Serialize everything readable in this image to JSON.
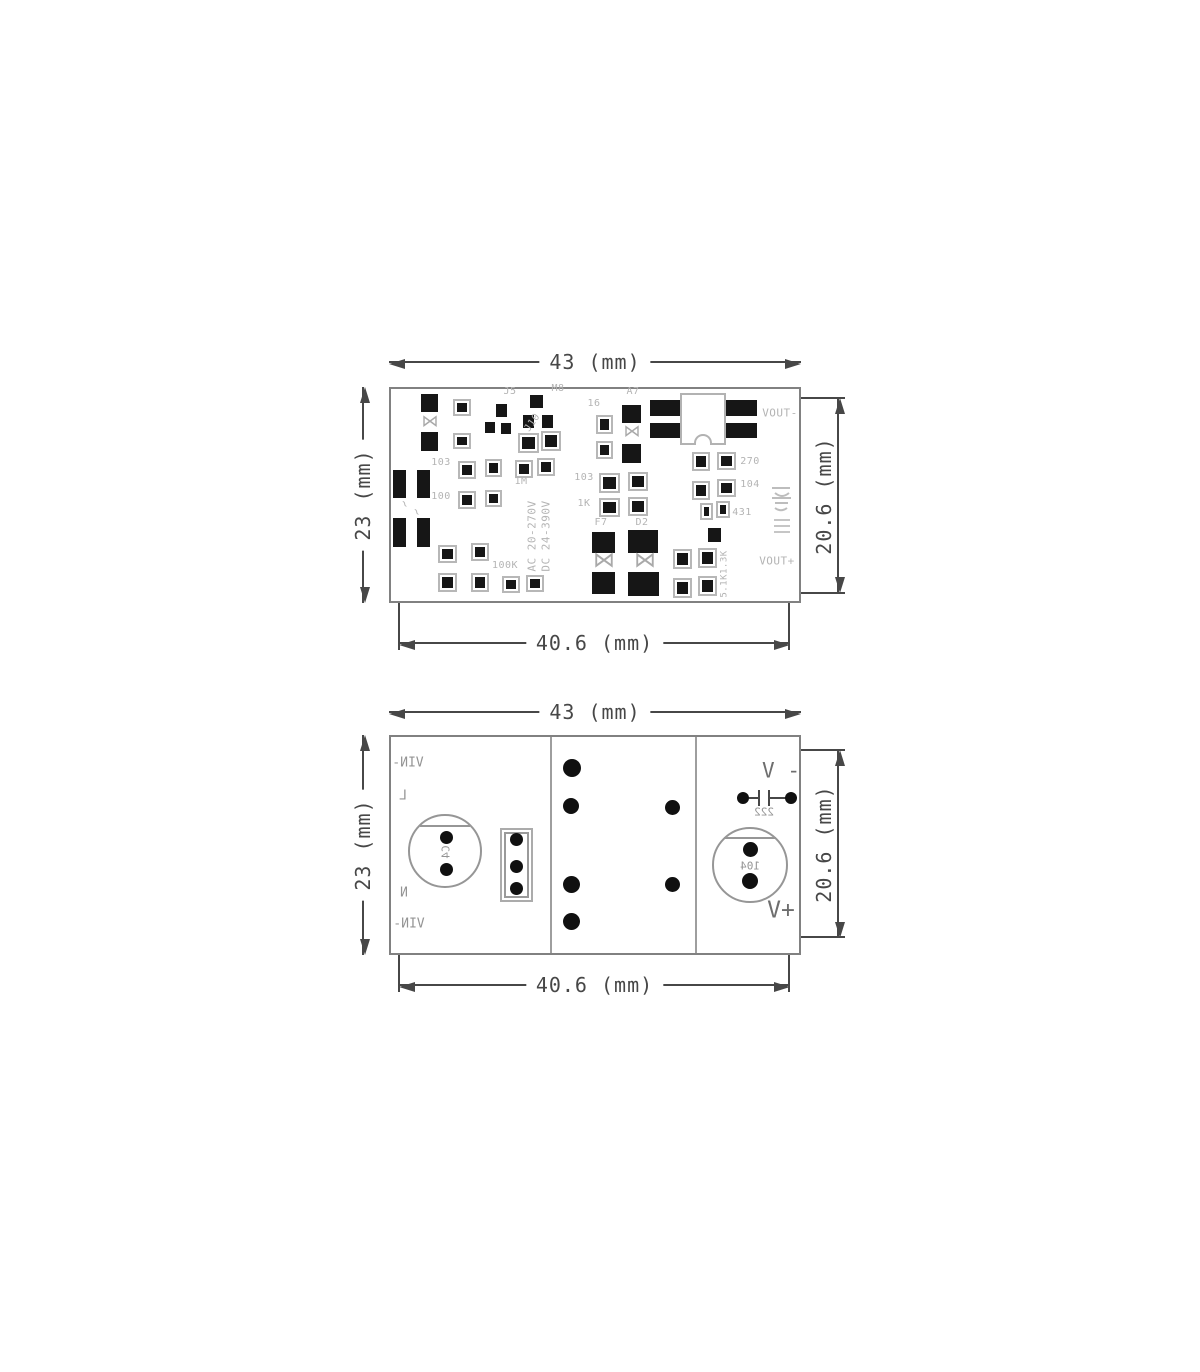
{
  "page": {
    "background": "#ffffff"
  },
  "colors": {
    "dimension": "#474747",
    "pcb_outline": "#818181",
    "pad": "#161616",
    "silkscreen": "#b4b4b4",
    "bottom_labels": "#949494",
    "voltage_labels": "#6e6e6e"
  },
  "icons": {
    "diode": "⋈",
    "dimension_arrow": "filled-triangle",
    "capacitor_symbol": "-||-"
  },
  "top_view": {
    "dims": {
      "top": "43 (mm)",
      "left": "23 (mm)",
      "right": "20.6 (mm)",
      "bottom": "40.6 (mm)"
    },
    "silkscreen": [
      {
        "t": "J5",
        "x": 510,
        "y": 392
      },
      {
        "t": "M8",
        "x": 558,
        "y": 389
      },
      {
        "t": "J10",
        "x": 533,
        "y": 423,
        "rot": -55
      },
      {
        "t": "16",
        "x": 594,
        "y": 404
      },
      {
        "t": "A7",
        "x": 633,
        "y": 392
      },
      {
        "t": "103",
        "x": 441,
        "y": 463
      },
      {
        "t": "100",
        "x": 441,
        "y": 497
      },
      {
        "t": "1M",
        "x": 521,
        "y": 482
      },
      {
        "t": "103",
        "x": 584,
        "y": 478
      },
      {
        "t": "1K",
        "x": 584,
        "y": 504
      },
      {
        "t": "F7",
        "x": 601,
        "y": 523
      },
      {
        "t": "D2",
        "x": 642,
        "y": 523
      },
      {
        "t": "100K",
        "x": 505,
        "y": 566
      },
      {
        "t": "270",
        "x": 750,
        "y": 462
      },
      {
        "t": "104",
        "x": 750,
        "y": 485
      },
      {
        "t": "431",
        "x": 742,
        "y": 513
      },
      {
        "t": "5.1K1.3K",
        "x": 725,
        "y": 574,
        "vert": 1,
        "fs": 9
      },
      {
        "t": "AC 20-270V",
        "x": 532,
        "y": 536,
        "vert": 1,
        "fs": 11
      },
      {
        "t": "DC 24-390V",
        "x": 546,
        "y": 536,
        "vert": 1,
        "fs": 11
      },
      {
        "t": "VOUT-",
        "x": 780,
        "y": 413,
        "fs": 11
      },
      {
        "t": "VOUT+",
        "x": 777,
        "y": 561,
        "fs": 11
      },
      {
        "t": "~",
        "x": 405,
        "y": 504,
        "rot": 60,
        "fs": 12
      },
      {
        "t": "~",
        "x": 417,
        "y": 512,
        "rot": 60,
        "fs": 12
      }
    ],
    "pads": [
      {
        "x": 421,
        "y": 394,
        "w": 17,
        "h": 18
      },
      {
        "x": 530,
        "y": 395,
        "w": 13,
        "h": 13
      },
      {
        "x": 496,
        "y": 404,
        "w": 11,
        "h": 13
      },
      {
        "x": 485,
        "y": 422,
        "w": 10,
        "h": 11
      },
      {
        "x": 501,
        "y": 423,
        "w": 10,
        "h": 11
      },
      {
        "x": 523,
        "y": 415,
        "w": 11,
        "h": 13
      },
      {
        "x": 542,
        "y": 415,
        "w": 11,
        "h": 13
      },
      {
        "x": 421,
        "y": 432,
        "w": 17,
        "h": 19
      },
      {
        "x": 393,
        "y": 470,
        "w": 13,
        "h": 28
      },
      {
        "x": 417,
        "y": 470,
        "w": 13,
        "h": 28
      },
      {
        "x": 393,
        "y": 518,
        "w": 13,
        "h": 29
      },
      {
        "x": 417,
        "y": 518,
        "w": 13,
        "h": 29
      },
      {
        "x": 622,
        "y": 405,
        "w": 19,
        "h": 18
      },
      {
        "x": 622,
        "y": 444,
        "w": 19,
        "h": 19
      },
      {
        "x": 592,
        "y": 532,
        "w": 23,
        "h": 21
      },
      {
        "x": 628,
        "y": 530,
        "w": 30,
        "h": 23
      },
      {
        "x": 592,
        "y": 572,
        "w": 23,
        "h": 22
      },
      {
        "x": 628,
        "y": 572,
        "w": 31,
        "h": 24
      },
      {
        "x": 650,
        "y": 400,
        "w": 31,
        "h": 16
      },
      {
        "x": 650,
        "y": 423,
        "w": 31,
        "h": 15
      },
      {
        "x": 725,
        "y": 400,
        "w": 32,
        "h": 16
      },
      {
        "x": 725,
        "y": 423,
        "w": 32,
        "h": 15
      },
      {
        "x": 708,
        "y": 528,
        "w": 13,
        "h": 14
      },
      {
        "x": 453,
        "y": 399,
        "w": 18,
        "h": 17,
        "o": 1
      },
      {
        "x": 453,
        "y": 433,
        "w": 18,
        "h": 16,
        "o": 1
      },
      {
        "x": 518,
        "y": 433,
        "w": 21,
        "h": 20,
        "o": 1
      },
      {
        "x": 541,
        "y": 431,
        "w": 20,
        "h": 20,
        "o": 1
      },
      {
        "x": 458,
        "y": 461,
        "w": 18,
        "h": 18,
        "o": 1
      },
      {
        "x": 485,
        "y": 459,
        "w": 17,
        "h": 18,
        "o": 1
      },
      {
        "x": 515,
        "y": 460,
        "w": 18,
        "h": 18,
        "o": 1
      },
      {
        "x": 537,
        "y": 458,
        "w": 18,
        "h": 18,
        "o": 1
      },
      {
        "x": 458,
        "y": 491,
        "w": 18,
        "h": 18,
        "o": 1
      },
      {
        "x": 485,
        "y": 490,
        "w": 17,
        "h": 17,
        "o": 1
      },
      {
        "x": 438,
        "y": 545,
        "w": 19,
        "h": 18,
        "o": 1
      },
      {
        "x": 471,
        "y": 543,
        "w": 18,
        "h": 18,
        "o": 1
      },
      {
        "x": 438,
        "y": 573,
        "w": 19,
        "h": 19,
        "o": 1
      },
      {
        "x": 471,
        "y": 573,
        "w": 18,
        "h": 19,
        "o": 1
      },
      {
        "x": 503,
        "y": 577,
        "w": 16,
        "h": 15,
        "o": 1
      },
      {
        "x": 527,
        "y": 576,
        "w": 16,
        "h": 15,
        "o": 1
      },
      {
        "x": 596,
        "y": 415,
        "w": 17,
        "h": 19,
        "o": 1
      },
      {
        "x": 596,
        "y": 441,
        "w": 17,
        "h": 18,
        "o": 1
      },
      {
        "x": 599,
        "y": 473,
        "w": 21,
        "h": 20,
        "o": 1
      },
      {
        "x": 628,
        "y": 472,
        "w": 20,
        "h": 19,
        "o": 1
      },
      {
        "x": 599,
        "y": 498,
        "w": 21,
        "h": 19,
        "o": 1
      },
      {
        "x": 628,
        "y": 497,
        "w": 20,
        "h": 19,
        "o": 1
      },
      {
        "x": 692,
        "y": 452,
        "w": 18,
        "h": 19,
        "o": 1
      },
      {
        "x": 717,
        "y": 452,
        "w": 19,
        "h": 18,
        "o": 1
      },
      {
        "x": 692,
        "y": 481,
        "w": 18,
        "h": 19,
        "o": 1
      },
      {
        "x": 717,
        "y": 479,
        "w": 19,
        "h": 18,
        "o": 1
      },
      {
        "x": 701,
        "y": 504,
        "w": 11,
        "h": 15,
        "o": 1
      },
      {
        "x": 717,
        "y": 502,
        "w": 12,
        "h": 15,
        "o": 1
      },
      {
        "x": 673,
        "y": 549,
        "w": 19,
        "h": 20,
        "o": 1
      },
      {
        "x": 698,
        "y": 548,
        "w": 19,
        "h": 20,
        "o": 1
      },
      {
        "x": 673,
        "y": 578,
        "w": 19,
        "h": 20,
        "o": 1
      },
      {
        "x": 698,
        "y": 576,
        "w": 19,
        "h": 20,
        "o": 1
      }
    ],
    "diodes": [
      {
        "x": 430,
        "y": 422,
        "s": 17
      },
      {
        "x": 632,
        "y": 432,
        "s": 17
      },
      {
        "x": 604,
        "y": 561,
        "s": 22
      },
      {
        "x": 645,
        "y": 561,
        "s": 22
      }
    ]
  },
  "bottom_view": {
    "dims": {
      "top": "43 (mm)",
      "left": "23 (mm)",
      "right": "20.6 (mm)",
      "bottom": "40.6 (mm)"
    },
    "labels": [
      {
        "t": "VIN-",
        "x": 408,
        "y": 763,
        "fs": 13,
        "mir": 1
      },
      {
        "t": "L",
        "x": 403,
        "y": 796,
        "fs": 13,
        "mir": 1
      },
      {
        "t": "N",
        "x": 404,
        "y": 893,
        "fs": 13,
        "mir": 1
      },
      {
        "t": "VIN-",
        "x": 409,
        "y": 924,
        "fs": 13,
        "mir": 1
      },
      {
        "t": "C4",
        "x": 446,
        "y": 852,
        "fs": 11,
        "mir": 1,
        "rot": -90
      },
      {
        "t": "222",
        "x": 764,
        "y": 812,
        "fs": 11,
        "mir": 1
      },
      {
        "t": "104",
        "x": 750,
        "y": 866,
        "fs": 11,
        "mir": 1
      },
      {
        "t": "V -",
        "x": 781,
        "y": 771,
        "fs": 21,
        "c": "#6e6e6e"
      },
      {
        "t": "V+",
        "x": 781,
        "y": 911,
        "fs": 23,
        "c": "#6e6e6e"
      }
    ],
    "dots": [
      {
        "x": 572,
        "y": 768,
        "d": 18
      },
      {
        "x": 571,
        "y": 806,
        "d": 16
      },
      {
        "x": 571,
        "y": 884,
        "d": 17
      },
      {
        "x": 571,
        "y": 921,
        "d": 17
      },
      {
        "x": 672,
        "y": 807,
        "d": 15
      },
      {
        "x": 672,
        "y": 884,
        "d": 15
      },
      {
        "x": 446,
        "y": 837,
        "d": 13
      },
      {
        "x": 446,
        "y": 869,
        "d": 13
      },
      {
        "x": 516,
        "y": 839,
        "d": 13
      },
      {
        "x": 516,
        "y": 866,
        "d": 13
      },
      {
        "x": 516,
        "y": 888,
        "d": 13
      },
      {
        "x": 743,
        "y": 798,
        "d": 12
      },
      {
        "x": 791,
        "y": 798,
        "d": 12
      },
      {
        "x": 750,
        "y": 849,
        "d": 15
      },
      {
        "x": 750,
        "y": 881,
        "d": 16
      }
    ]
  }
}
